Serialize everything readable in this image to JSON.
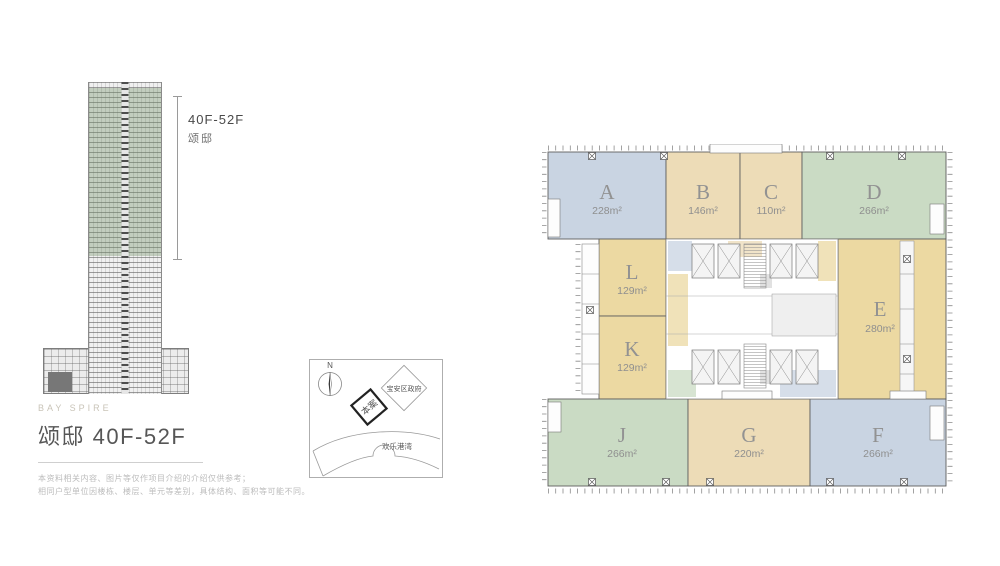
{
  "building_elevation": {
    "label_floors": "40F-52F",
    "label_name": "颂邸"
  },
  "project_info": {
    "subtitle_en": "BAY SPIRE",
    "title": "颂邸 40F-52F",
    "disclaimer1": "本资料相关内容、图片等仅作项目介绍的介绍仅供参考；",
    "disclaimer2": "相同户型单位因楼栋、楼层、单元等差别，具体结构、面积等可能不同。"
  },
  "site_map": {
    "north": "N",
    "project": "本案",
    "government": "宝安区政府",
    "bay": "欢乐港湾"
  },
  "floor_plan": {
    "units": [
      {
        "id": "A",
        "area": "228m²",
        "color": "#c9d4e2"
      },
      {
        "id": "B",
        "area": "146m²",
        "color": "#eddcb7"
      },
      {
        "id": "C",
        "area": "110m²",
        "color": "#eddcb7"
      },
      {
        "id": "D",
        "area": "266m²",
        "color": "#cadbc4"
      },
      {
        "id": "E",
        "area": "280m²",
        "color": "#ecd9a2"
      },
      {
        "id": "F",
        "area": "266m²",
        "color": "#c9d4e2"
      },
      {
        "id": "G",
        "area": "220m²",
        "color": "#eddcb7"
      },
      {
        "id": "J",
        "area": "266m²",
        "color": "#cadbc4"
      },
      {
        "id": "K",
        "area": "129m²",
        "color": "#ecd9a2"
      },
      {
        "id": "L",
        "area": "129m²",
        "color": "#ecd9a2"
      }
    ]
  },
  "colors": {
    "unit_blue": "#c9d4e2",
    "unit_tan": "#eddcb7",
    "unit_green": "#cadbc4",
    "unit_yellow": "#ecd9a2",
    "highlight_green": "#76946c",
    "line_gray": "#666666",
    "label_gray": "#929292"
  }
}
